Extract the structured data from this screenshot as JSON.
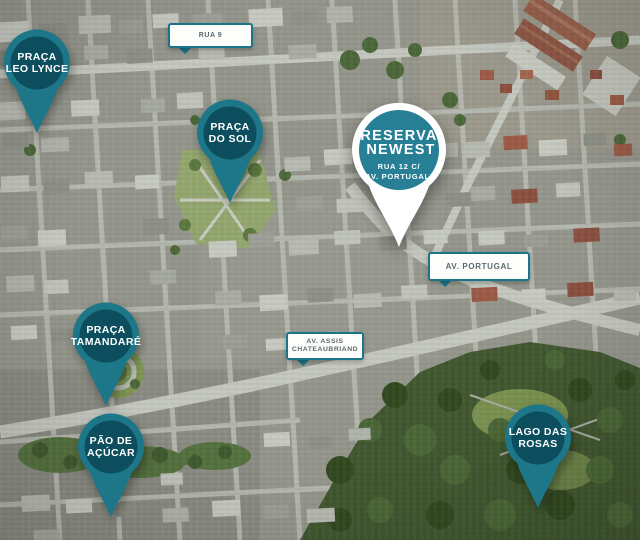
{
  "map": {
    "kind": "satellite-aerial-view",
    "colors": {
      "pin_teal": "#1e7689",
      "pin_inner_dark": "#0c4e5d",
      "featured_pin_white": "#ffffff",
      "featured_circle_teal": "#277f96",
      "street_label_border": "#1d7488",
      "street_label_text": "#5a6a70",
      "park_green": "#40572f"
    }
  },
  "pins": [
    {
      "id": "praca-leo-lynce",
      "line1": "PRAÇA",
      "line2": "LEO LYNCE"
    },
    {
      "id": "praca-do-sol",
      "line1": "PRAÇA",
      "line2": "DO SOL"
    },
    {
      "id": "praca-tamandare",
      "line1": "PRAÇA",
      "line2": "TAMANDARÉ"
    },
    {
      "id": "pao-de-acucar",
      "line1": "PÃO DE",
      "line2": "AÇÚCAR"
    },
    {
      "id": "lago-das-rosas",
      "line1": "LAGO DAS",
      "line2": "ROSAS"
    }
  ],
  "featured_pin": {
    "brand_line1": "RESERVA",
    "brand_line2": "NEWEST",
    "address_line1": "RUA 12 C/",
    "address_line2": "AV. PORTUGAL."
  },
  "street_labels": [
    {
      "id": "rua-9",
      "text": "RUA 9"
    },
    {
      "id": "av-portugal",
      "text": "AV. PORTUGAL"
    },
    {
      "id": "av-assis-chateaubriand",
      "line1": "AV. ASSIS",
      "line2": "CHATEAUBRIAND"
    }
  ]
}
